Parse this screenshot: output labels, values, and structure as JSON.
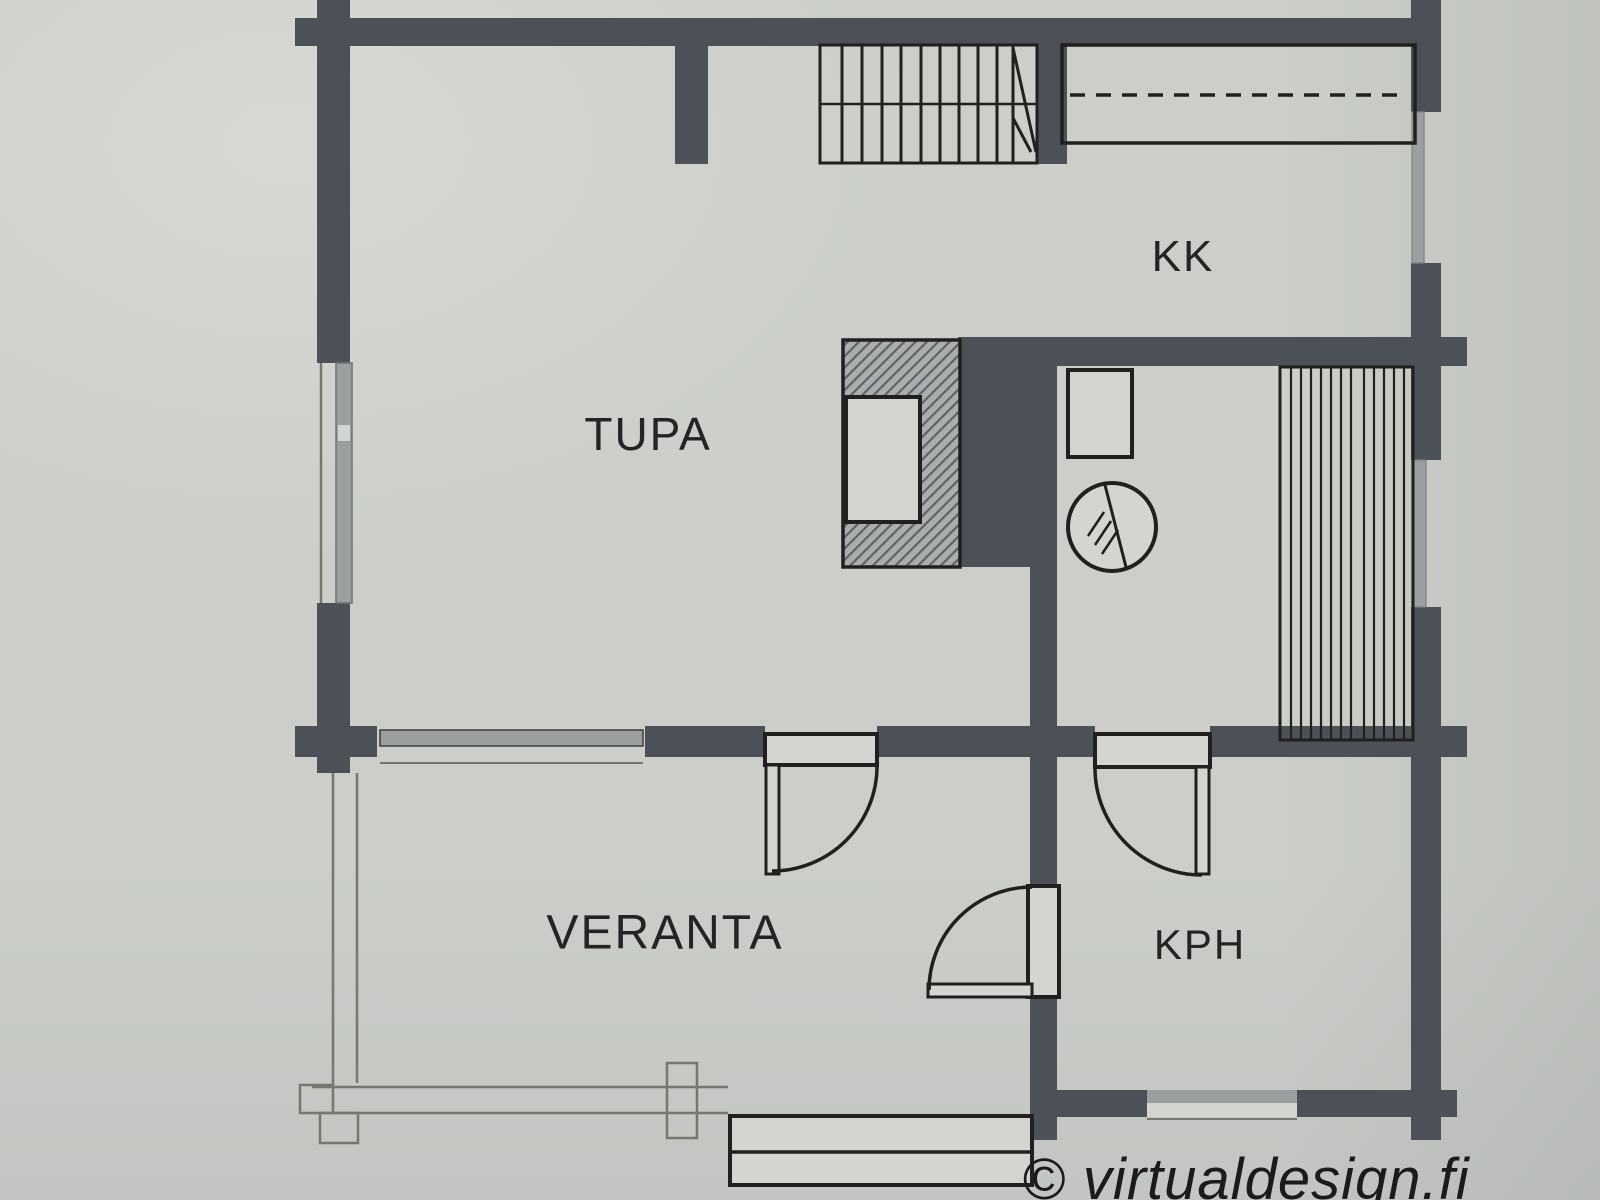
{
  "plan": {
    "rooms": {
      "tupa": "TUPA",
      "kk": "KK",
      "veranta": "VERANTA",
      "kph": "KPH"
    },
    "watermark": "© virtualdesign.fi"
  },
  "colors": {
    "paper": "#cbcec9",
    "paper2": "#d3d5d1",
    "wall": "#4c5157",
    "line": "#20211f",
    "thin": "#75786f",
    "label": "#242424",
    "hatchbg": "#abaeae",
    "hatchln": "#5f6366",
    "winGray": "#9b9fa0"
  }
}
